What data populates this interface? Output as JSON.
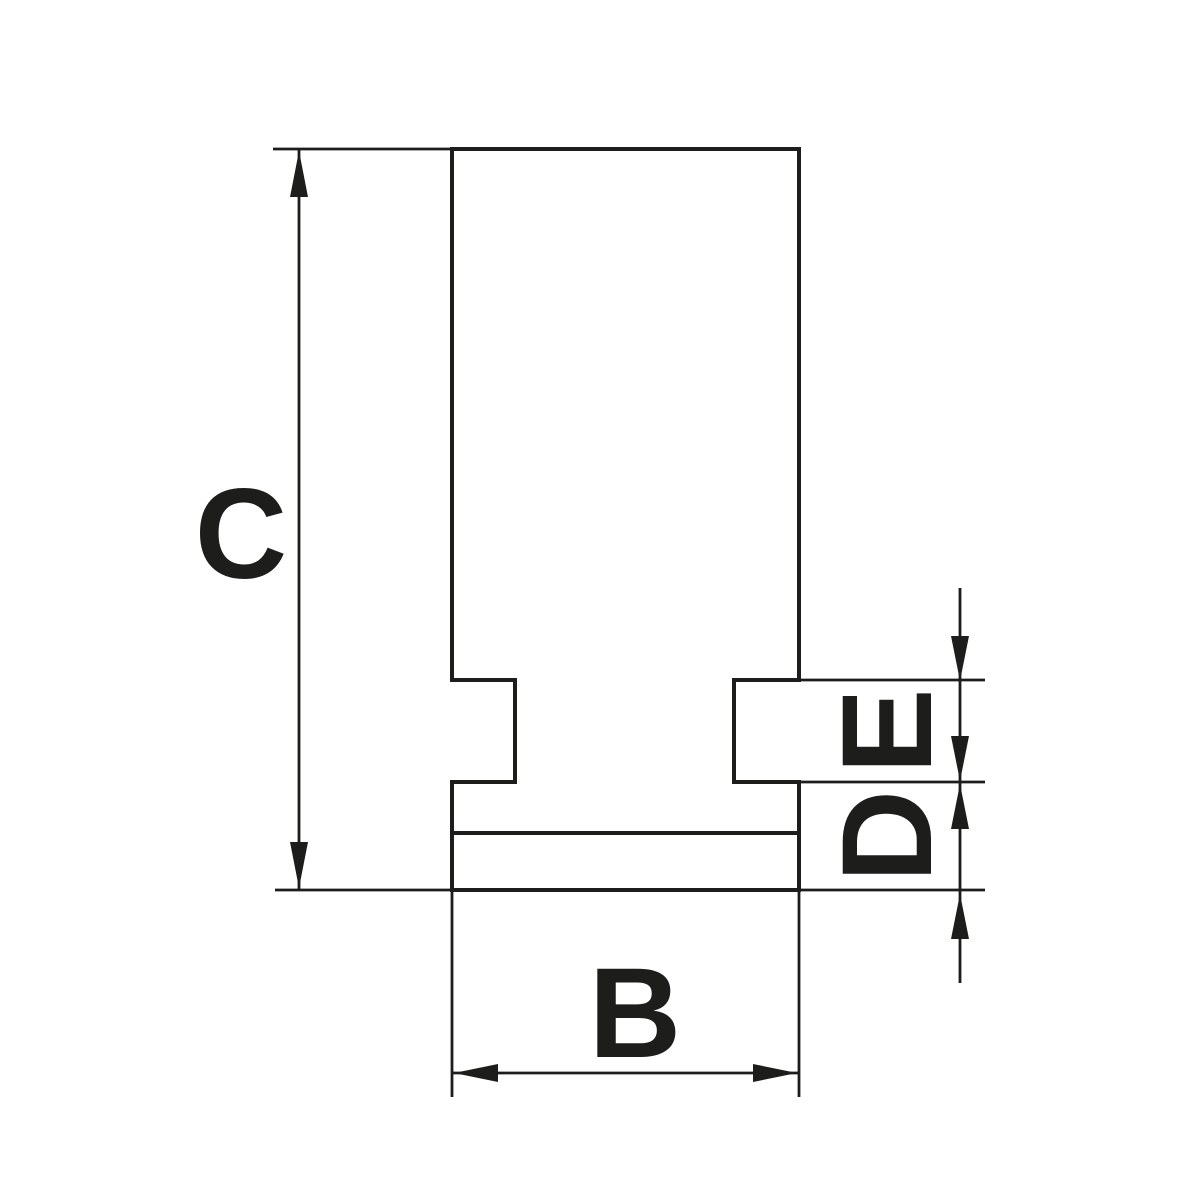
{
  "colors": {
    "line": "#1d1d1b",
    "background": "#ffffff"
  },
  "drawing": {
    "kind": "technical-dimension-drawing",
    "dimension_labels": {
      "overall_height": "C",
      "overall_width": "B",
      "groove_height": "E",
      "base_height": "D"
    }
  }
}
